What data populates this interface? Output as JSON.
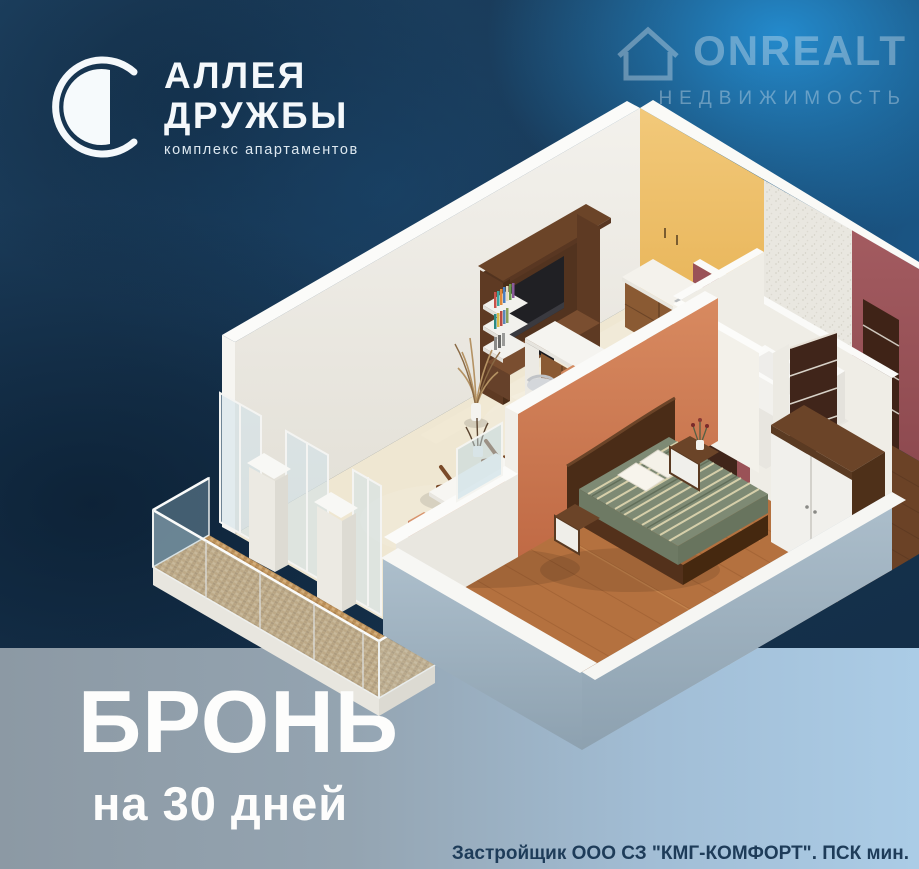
{
  "logo": {
    "title_line1": "АЛЛЕЯ",
    "title_line2": "ДРУЖБЫ",
    "subtitle": "комплекс апартаментов",
    "icon": "crescent-moon-icon"
  },
  "watermark": {
    "brand": "ONREALT",
    "tagline": "НЕДВИЖИМОСТЬ",
    "icon": "house-icon"
  },
  "offer": {
    "headline": "БРОНЬ",
    "subline": "на 30 дней"
  },
  "legal": {
    "text": "Застройщик ООО СЗ \"КМГ-КОМФОРТ\". ПСК мин."
  },
  "palette": {
    "background_navy": "#16334e",
    "background_bright_blue": "#2388cc",
    "bottom_band_left": "#8c99a4",
    "bottom_band_right": "#abcce6",
    "wall_white": "#efede6",
    "kitchen_accent_yellow": "#eec06a",
    "bedroom_accent_terracotta": "#cd7a52",
    "hall_wall_maroon": "#9a5257",
    "sofa_terracotta": "#c97a52",
    "bed_stripe_green": "#7e8a74",
    "wood_floor": "#b4713f",
    "dark_wood": "#4a2c17",
    "balcony_tile_tan": "#c9a06a",
    "living_floor_cream": "#efe7d2"
  },
  "floorplan": {
    "type": "3d-isometric-apartment-render",
    "rooms": [
      "living-room",
      "kitchen",
      "bathroom",
      "hallway",
      "bedroom",
      "balcony"
    ],
    "furniture": [
      "tv-shelf-unit",
      "sofa",
      "armchair",
      "coffee-table",
      "bar-counter",
      "bar-stools",
      "kitchen-cabinets-sink",
      "bathtub",
      "toilet",
      "washing-machine",
      "double-bed-striped-duvet",
      "nightstands",
      "wardrobe",
      "glass-balcony-railing"
    ]
  }
}
